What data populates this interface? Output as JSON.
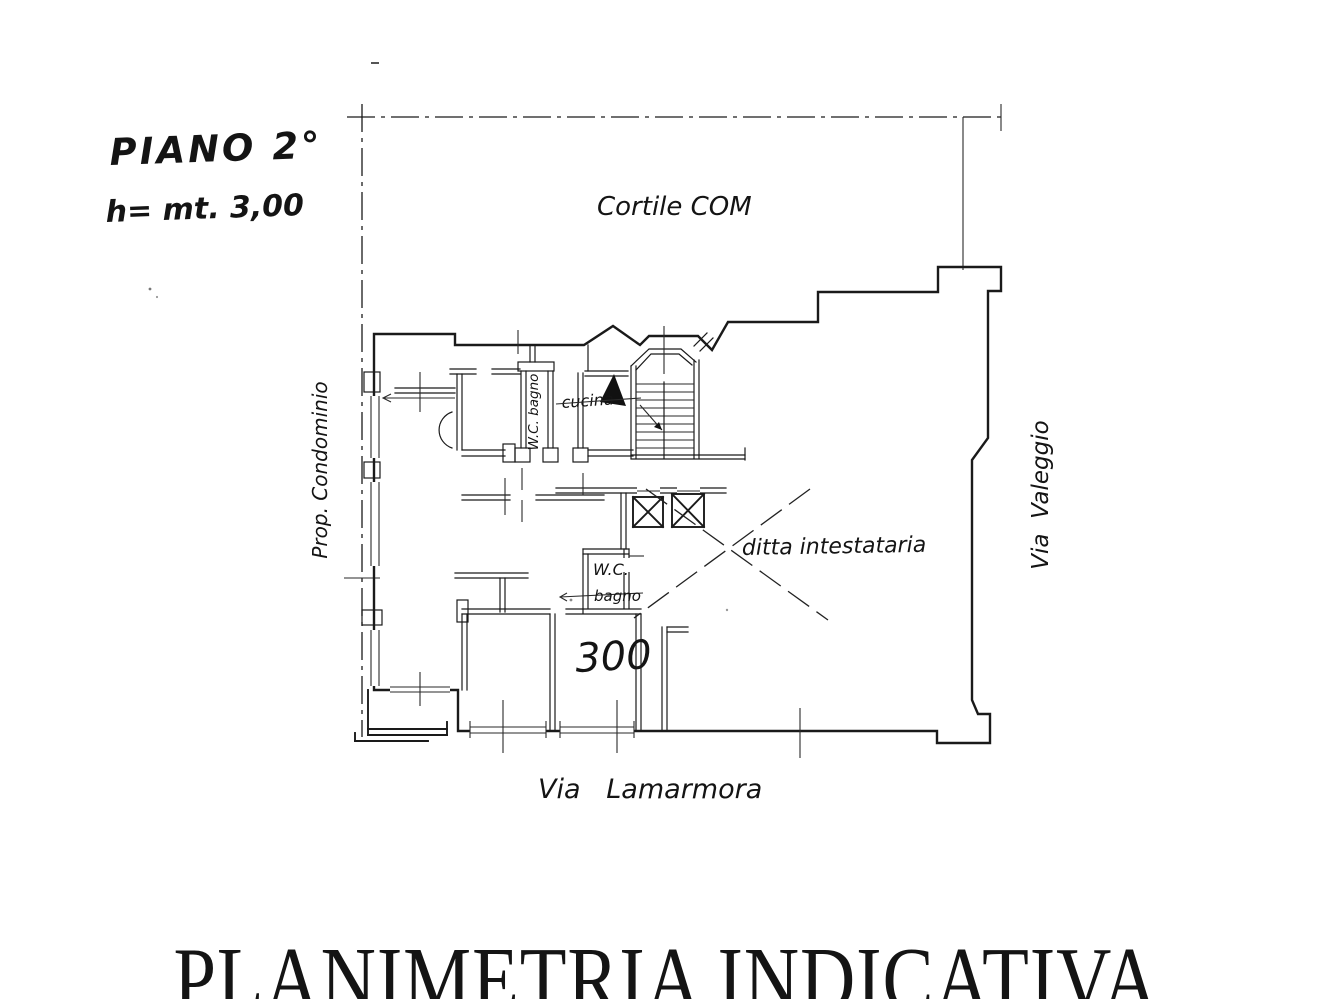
{
  "header": {
    "floor_label": "PIANO 2°",
    "height_label": "h= mt. 3,00"
  },
  "plan_labels": {
    "courtyard": "Cortile COM",
    "left_boundary": "Prop. Condominio",
    "street_right": "Via  Valeggio",
    "street_bottom": "Via   Lamarmora",
    "tenant": "ditta intestataria",
    "room_wc_top": "W.C. bagno",
    "room_kitchen": "cucina",
    "room_wc_center": "W.C.",
    "room_bath_center": "bagno",
    "room_number": "300"
  },
  "footer": {
    "caption": "PLANIMETRIA INDICATIVA"
  },
  "colors": {
    "ink": "#1a1a1a",
    "paper": "#ffffff"
  }
}
